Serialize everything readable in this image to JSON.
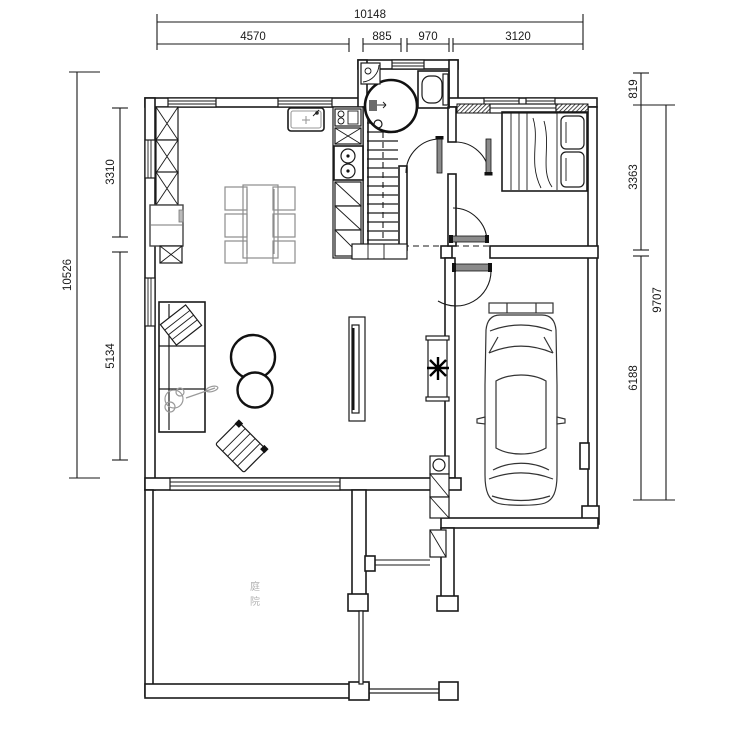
{
  "dimensions": {
    "top": {
      "overall": "10148",
      "seg1": "4570",
      "seg2": "885",
      "seg3": "970",
      "seg4": "3120"
    },
    "left": {
      "overall": "10526",
      "seg1": "3310",
      "seg2": "5134"
    },
    "right": {
      "overall": "9707",
      "seg1": "819",
      "seg2": "3363",
      "seg3": "6188"
    }
  },
  "labels": {
    "courtyard_char1": "庭",
    "courtyard_char2": "院"
  },
  "colors": {
    "line": "#1a1a1a",
    "furniture_gray": "#9a9a9a",
    "background": "#ffffff"
  }
}
